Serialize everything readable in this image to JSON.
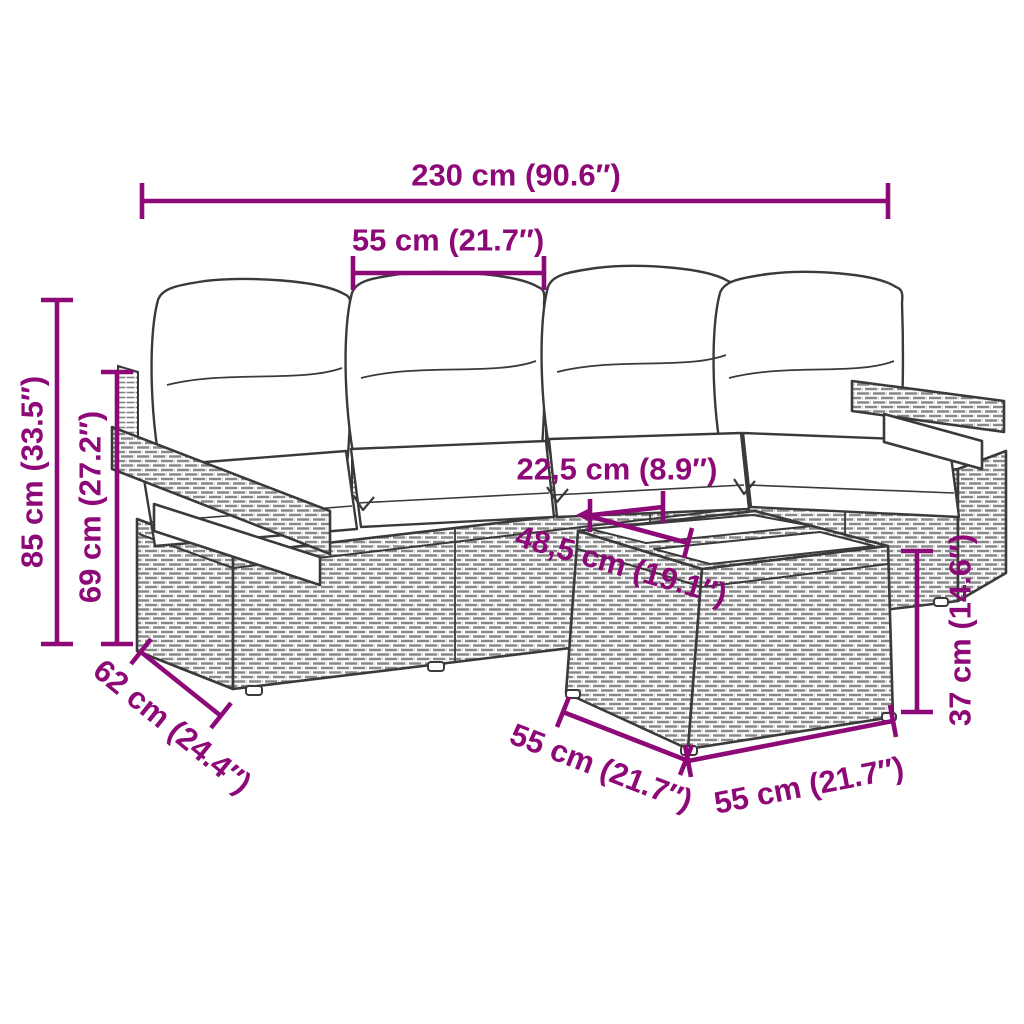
{
  "page": {
    "type": "product-dimension-diagram",
    "background": "#ffffff"
  },
  "product": {
    "name": "rattan garden lounge set with cushions and glass-top table",
    "pieces": "4-seat wicker sofa with two armrests, 4 back pillows, 4 seat cushions, cube side table with 2 glass panels"
  },
  "colors": {
    "dimension": "#8d0977",
    "art_line": "#3a3a3a",
    "wicker_hatch": "#8a8a8a",
    "cushion_fill": "#ffffff"
  },
  "dimensions": {
    "overall_width": {
      "label": "230 cm (90.6″)",
      "orientation": "horizontal"
    },
    "seat_module_width": {
      "label": "55 cm (21.7″)",
      "orientation": "horizontal"
    },
    "overall_height": {
      "label": "85 cm (33.5″)",
      "orientation": "vertical"
    },
    "backrest_height": {
      "label": "69 cm (27.2″)",
      "orientation": "vertical"
    },
    "seat_depth": {
      "label": "62 cm (24.4″)",
      "orientation": "diagonal"
    },
    "glass_panel_depth": {
      "label": "22,5 cm (8.9″)",
      "orientation": "horizontal"
    },
    "glass_panel_width": {
      "label": "48,5 cm (19.1″)",
      "orientation": "diagonal"
    },
    "table_depth": {
      "label": "55 cm (21.7″)",
      "orientation": "diagonal"
    },
    "table_width": {
      "label": "55 cm (21.7″)",
      "orientation": "diagonal"
    },
    "table_height": {
      "label": "37 cm (14.6″)",
      "orientation": "vertical"
    }
  }
}
